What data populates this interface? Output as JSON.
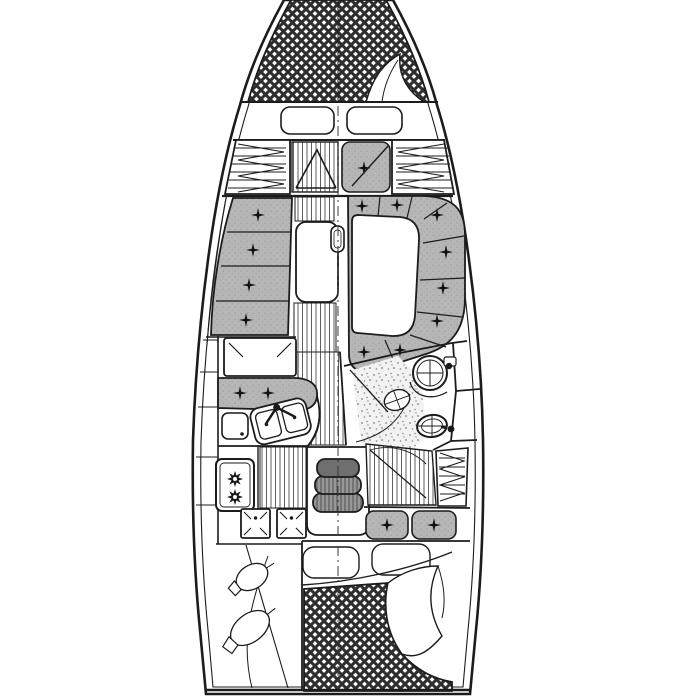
{
  "page": {
    "title": "Sailing yacht interior layout plan"
  },
  "meta": {
    "description": "Black-and-white top-down naval architecture drawing of a sailboat interior arrangement",
    "image_width": 674,
    "image_height": 700
  },
  "colors": {
    "background": "#ffffff",
    "line": "#1c1c1c",
    "cushion": "#b6b6b6",
    "cushion_dot": "#a4a4a4",
    "floor_stripe": "#5f5f5f",
    "hatch": "#2e2e2e",
    "step_fill": "#979797",
    "step_dark": "#6f6f6f",
    "stipple": "#828282"
  },
  "regions": {
    "hull": "Hull outline with inner deck line",
    "v_berth": "Forward V-berth, crosshatched double mattress",
    "v_berth_sheet": "Turned-back sheet corner on V-berth",
    "fwd_seats": "Two seat cushions at foot of V-berth",
    "port_fwd_locker": "Port forward hanging locker with shelves",
    "stbd_fwd_locker": "Starboard forward hanging locker with shelves",
    "fwd_cabin_floor": "Forward cabin sole with double doors",
    "fwd_cabin_seat": "Forward cabin seat cushion with door",
    "port_settee": "Port straight settee, four buttoned cushions",
    "port_shelf": "Port side shelf along hull",
    "salon_table": "Saloon drop-leaf table",
    "mast_post": "Mast post at centreline beside table",
    "dinette": "Starboard wrap-around dinette settee, buttoned cushions",
    "dinette_table": "Dinette table",
    "chart_table": "Chart table with lid marks",
    "nav_seat": "Navigator seat cushions",
    "galley_counter": "Galley worktop",
    "galley_sink": "Twin galley sinks with mixer tap",
    "icebox": "Icebox top-loading lid",
    "stove": "Two-burner stove",
    "galley_hatches": "Two access hatches with corner marks",
    "galley_sole": "Galley sole, planked",
    "walkway": "Central walkway, planked sole",
    "companionway": "Companionway steps",
    "head_compartment": "Head compartment walls",
    "head_sink": "Round washbasin with tap",
    "head_basin": "Small oval drain basin",
    "head_shower": "Stippled shower floor",
    "toilet": "Marine toilet with pump",
    "aft_corridor": "Passage to aft cabin, planked sole with door",
    "aft_locker": "Aft hanging locker with shelves",
    "aft_seats": "Aft cabin seat cushions",
    "aft_pillows": "Aft berth pillows",
    "aft_berth": "Aft double berth, crosshatched mattress",
    "aft_sheet": "Turned-back sheet corner on aft berth",
    "lazarette": "Port cockpit locker with two fenders",
    "centerline": "Centreline, dash-dot",
    "transom": "Transom"
  }
}
